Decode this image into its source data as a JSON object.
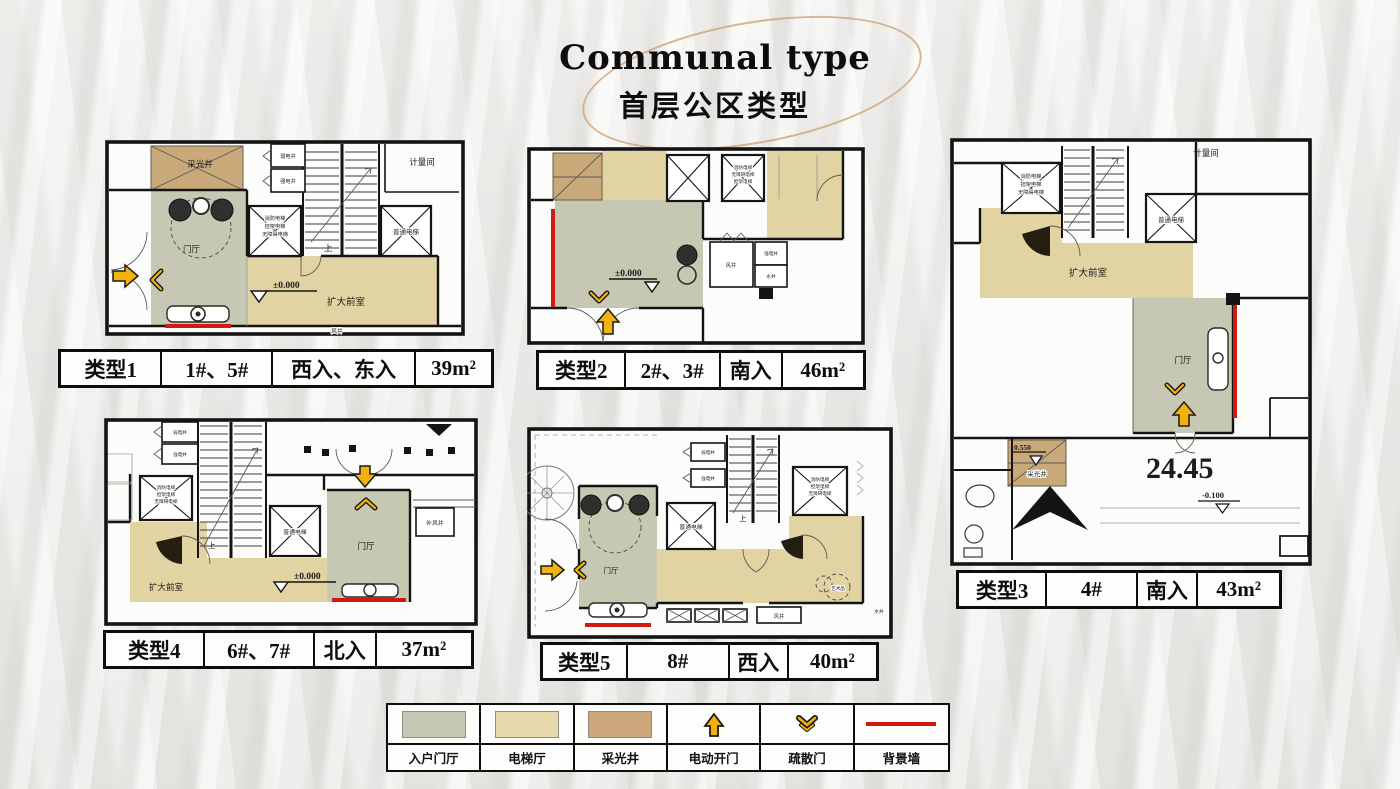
{
  "title": {
    "en": "Communal type",
    "zh": "首层公区类型"
  },
  "tables": [
    {
      "cells": [
        "类型1",
        "1#、5#",
        "西入、东入",
        "39m²"
      ]
    },
    {
      "cells": [
        "类型2",
        "2#、3#",
        "南入",
        "46m²"
      ]
    },
    {
      "cells": [
        "类型3",
        "4#",
        "南入",
        "43m²"
      ]
    },
    {
      "cells": [
        "类型4",
        "6#、7#",
        "北入",
        "37m²"
      ]
    },
    {
      "cells": [
        "类型5",
        "8#",
        "西入",
        "40m²"
      ]
    }
  ],
  "legend": {
    "items": [
      "入户门厅",
      "电梯厅",
      "采光井",
      "电动开门",
      "疏散门",
      "背景墙"
    ],
    "colors": {
      "entry_foyer": "#c6c8b4",
      "elevator_hall": "#e5d8a9",
      "light_well": "#cda87c",
      "arrow_yellow": "#f2b10b",
      "accent_wall_red": "#d41910"
    }
  },
  "labels": {
    "light_well": "采光井",
    "foyer": "门厅",
    "enlarged_lobby": "扩大前室",
    "fire_elevator_l1": "消防电梯",
    "fire_elevator_l2": "担架电梯",
    "fire_elevator_l3": "无障碍电梯",
    "normal_elevator": "普通电梯",
    "meter_room": "计量间",
    "weak_shaft": "弱电井",
    "strong_shaft": "强电井",
    "water_shaft": "水井",
    "wind_shaft": "风井",
    "makeup_air_shaft": "补风井",
    "up": "上",
    "level_zero": "±0.000",
    "art_piece": "艺术品",
    "dim_2445": "24.45",
    "level_0550": "0.550",
    "level_neg_0100": "-0.100"
  }
}
